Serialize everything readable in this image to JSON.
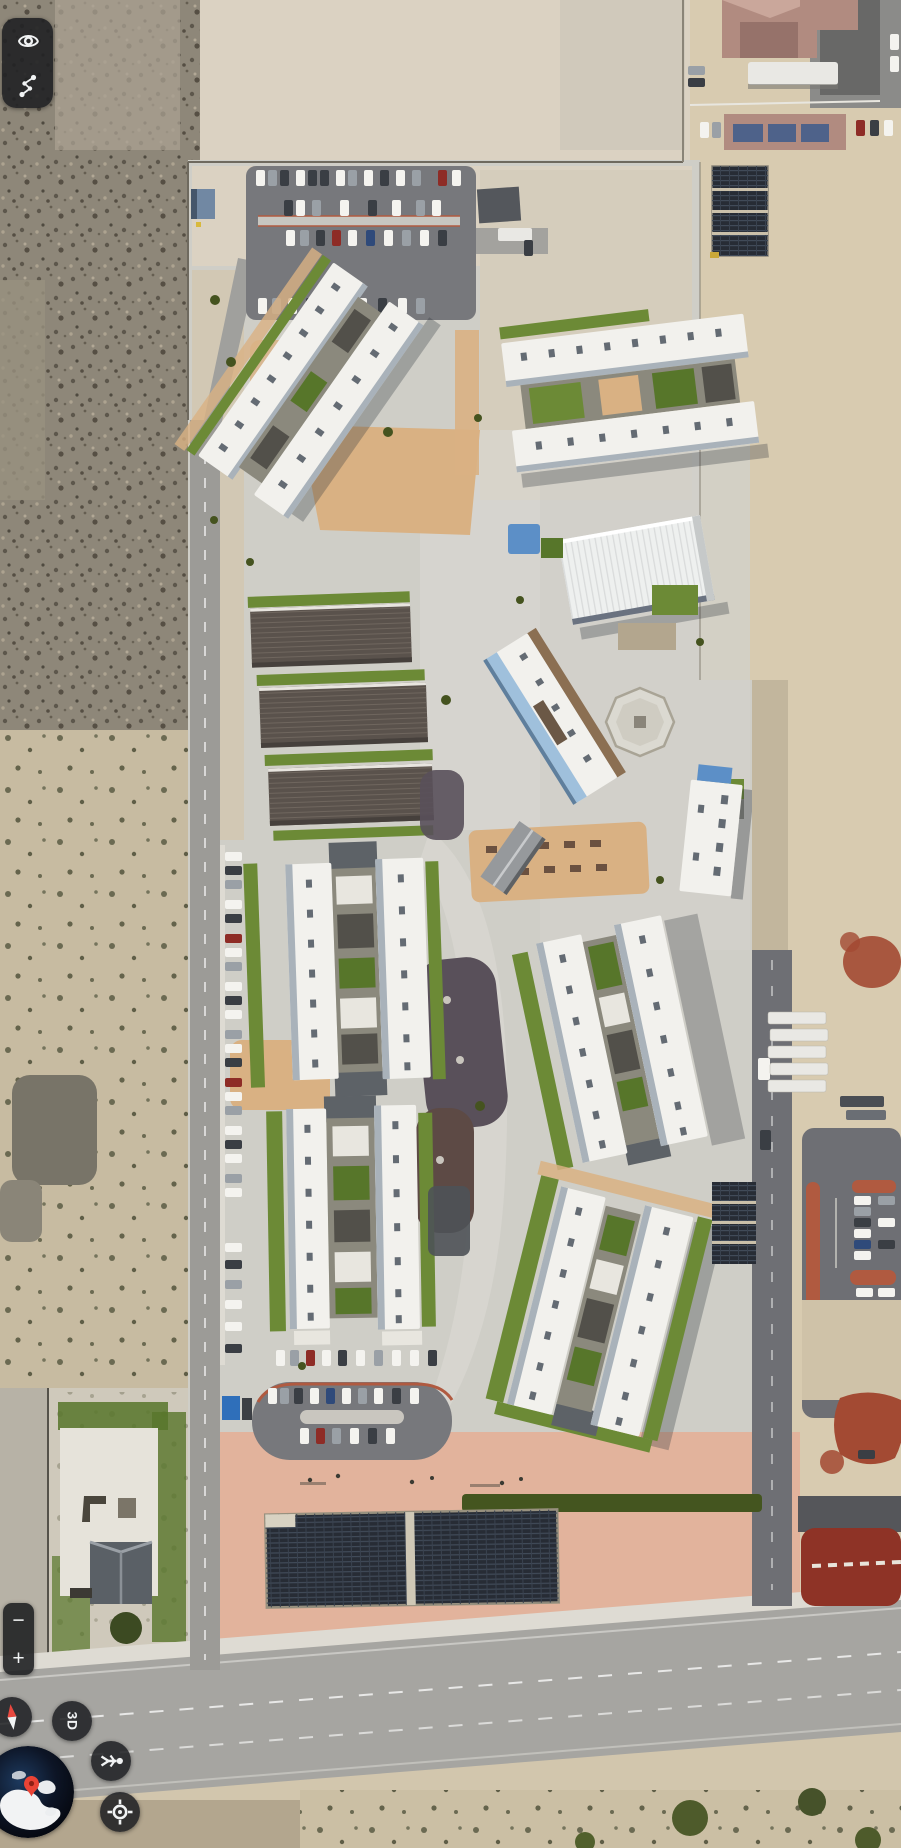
{
  "ui": {
    "layers_toolbar": {
      "eye_icon": "eye-icon",
      "measure_icon": "measure-path-icon"
    },
    "zoom": {
      "out_label": "−",
      "in_label": "+"
    },
    "compass": {
      "icon": "compass-needle-icon"
    },
    "view3d": {
      "label": "3D"
    },
    "streetview": {
      "icon": "pegman-icon"
    },
    "locate": {
      "icon": "my-location-icon"
    },
    "globe": {
      "icon": "earth-overview-globe",
      "pin": "red-location-pin"
    }
  },
  "map": {
    "type": "satellite-imagery",
    "features": [
      "desert-scrubland",
      "walled-apartment-campus",
      "white-roof-apartment-clusters",
      "brown-roof-classroom-rows",
      "white-warehouse",
      "octagonal-pavilion",
      "solar-panel-arrays",
      "parking-lots-with-cars",
      "green-lawns",
      "picnic-courtyard",
      "red-roof-complex",
      "running-track-corner",
      "perimeter-roads"
    ]
  },
  "palette": {
    "sand": "#d2c6ad",
    "sandLight": "#dbd2c2",
    "sandPale": "#d0c9bb",
    "sandRight": "#d8cbb0",
    "scrub": "#8e8779",
    "desertLeft": "#c7bba1",
    "darkPatch": "#787468",
    "concrete": "#cfcec7",
    "concreteBright": "#dad9d3",
    "sidewalk": "#dedbd3",
    "road": "#9c9b97",
    "roadMajor": "#a6a5a1",
    "asphalt": "#77787c",
    "asphaltDark": "#6e6f74",
    "lawn": "#6c8a36",
    "lawnDark": "#57762a",
    "hedge": "#44551f",
    "gravel": "#d9b183",
    "salmon": "#e2b39c",
    "roofWhite": "#f2f1ed",
    "roofShade": "#a9b2ba",
    "roofMark": "#646b73",
    "roofGray": "#96999c",
    "roofBrown": "#5a524c",
    "ridgeBrown": "#6f665e",
    "courtyard": "#8b897d",
    "pit": "#52504a",
    "playDark": "#59505a",
    "playRust": "#5d4a45",
    "solar": "#272c35",
    "solarLine": "#414b59",
    "solarGap": "#cac0aa",
    "redCurb": "#b05a40",
    "redTrack": "#8e3326",
    "redSplash": "#a34a33",
    "redRoof": "#b18b80",
    "redRoofDark": "#96726a",
    "metalBlue": "#9fc0dc",
    "canopyBlue": "#5c8fc7",
    "dumpsterBlue": "#2f6fba",
    "trailerWhite": "#e9e8e4",
    "shadow": "#2f343b",
    "carWhite": "#f4f3ef",
    "carGray": "#9aa0a6",
    "carDark": "#3a3e44",
    "carRed": "#8e2c26",
    "carBlue": "#2f4a7a",
    "uiDark": "#202124",
    "uiIcon": "#f1f3f4",
    "compassRed": "#e8483f",
    "pinRed": "#ea4335",
    "globeOcean": "#0d1526"
  }
}
